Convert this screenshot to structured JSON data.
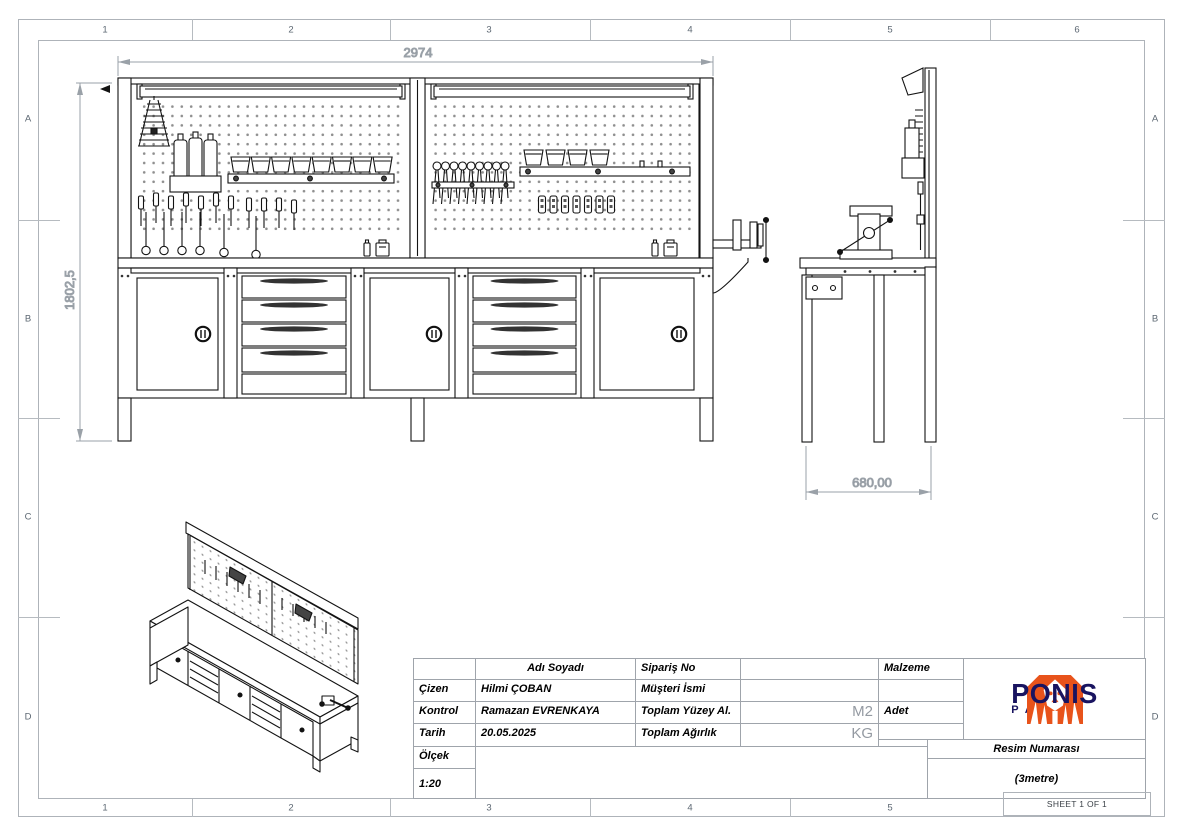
{
  "border": {
    "cols_top": [
      "1",
      "2",
      "3",
      "4",
      "5",
      "6"
    ],
    "cols_bottom": [
      "1",
      "2",
      "3",
      "4",
      "5"
    ],
    "rows_left": [
      "A",
      "B",
      "C",
      "D"
    ],
    "rows_right": [
      "A",
      "B",
      "C",
      "D"
    ],
    "sheet_label": "SHEET 1 OF 1"
  },
  "dimensions": {
    "width": "2974",
    "height": "1802,5",
    "depth": "680,00"
  },
  "title_block": {
    "header_name": "Adı Soyadı",
    "rows": [
      {
        "label": "Çizen",
        "value": "Hilmi ÇOBAN"
      },
      {
        "label": "Kontrol",
        "value": "Ramazan EVRENKAYA"
      },
      {
        "label": "Tarih",
        "value": "20.05.2025"
      }
    ],
    "scale_label": "Ölçek",
    "scale_value": "1:20",
    "right_rows": [
      {
        "label": "Sipariş No",
        "value": "",
        "unit": ""
      },
      {
        "label": "Müşteri İsmi",
        "value": "",
        "unit": ""
      },
      {
        "label": "Toplam Yüzey Al.",
        "value": "",
        "unit": "M2"
      },
      {
        "label": "Toplam Ağırlık",
        "value": "",
        "unit": "KG"
      }
    ],
    "malzeme_label": "Malzeme",
    "adet_label": "Adet",
    "resim_label": "Resim Numarası",
    "resim_value": "(3metre)"
  },
  "logo": {
    "brand": "PONIS",
    "sub": "PANO",
    "orange": "#e8531b",
    "navy": "#191460"
  }
}
